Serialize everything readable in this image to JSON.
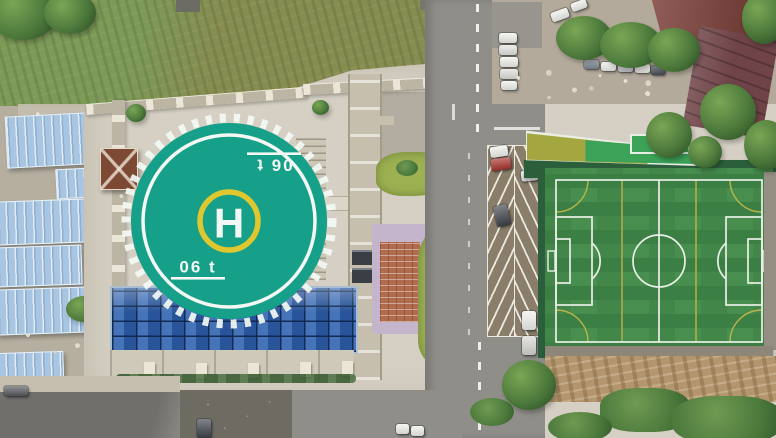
{
  "scene": {
    "type": "aerial-photo",
    "description": "Aerial drone view of a rooftop helipad on a campus building beside an artificial-turf soccer field, with roadside angled parking, blue-roofed sheds, a gravel car park with cars, trees and red-roofed buildings"
  },
  "helipad": {
    "letter": "H",
    "weight_marking": "06 t"
  },
  "colors": {
    "paving": "#d5d0c3",
    "pavingDark": "#a9a399",
    "concrete": "#b6afa0",
    "grass": "#7d9a58",
    "grassDark": "#5d7f43",
    "scrub": "#878c51",
    "tree": "#4d7a3c",
    "treeDark": "#2f5227",
    "treeLight": "#7aa655",
    "teal": "#16a089",
    "padWhite": "#f3f8f4",
    "yellow": "#dfc72f",
    "glass": "#2f5fa8",
    "glassFrame": "#a9bdd3",
    "roofBlue": "#a8c6e2",
    "road": "#8f8e89",
    "roadDark": "#6d6b62",
    "island": "#8a7e6a",
    "stripe": "#ece9df",
    "turf": "#478e4f",
    "turfDark": "#3c7f44",
    "turfLine": "#eaf0e6",
    "turfYellow": "#c7bb49",
    "fence": "#2b5f3c",
    "canopyGreen": "#3ba258",
    "canopyOlive": "#a4a740",
    "gravel": "#b3aa9b",
    "dirt": "#b3966e",
    "brick": "#b06c4c",
    "purple": "#c4b4cc",
    "roofRed": "#7c3b34",
    "roofMaroon": "#6f4347",
    "pavilion": "#7b4934",
    "wall": "#bdb5a4",
    "wallPost": "#ece6d8",
    "hedge": "#3a5c33",
    "lawn": "#9db153",
    "carWhite": "#f0f0ec",
    "carRed": "#a8322a",
    "carDark": "#3e434a",
    "facade": "#cfc9ba",
    "rubble": "#c6bfb0"
  }
}
